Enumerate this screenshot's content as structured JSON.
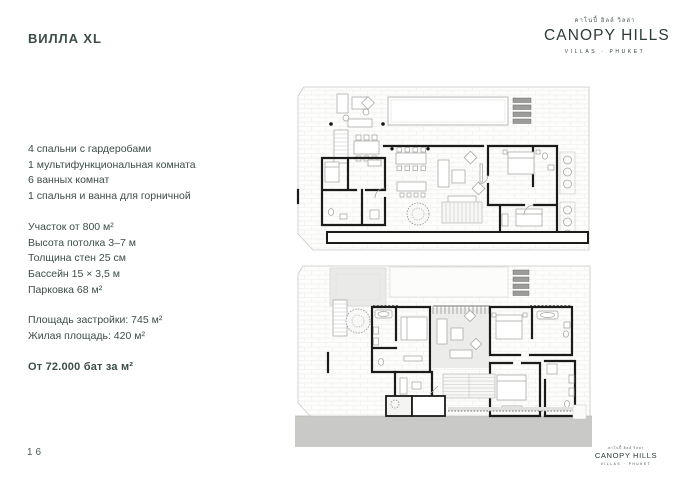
{
  "page": {
    "title": "ВИЛЛА XL",
    "page_number": "16"
  },
  "logo": {
    "thai_script": "คาโนปี้ ฮิลล์ วิลล่า",
    "brand": "CANOPY HILLS",
    "tagline": "VILLAS · PHUKET"
  },
  "specs": {
    "rooms": [
      "4 спальни с гардеробами",
      "1 мультифункциональная комната",
      "6 ванных комнат",
      "1 спальня и ванна для горничной"
    ],
    "details": [
      "Участок от 800 м²",
      "Высота потолка 3–7 м",
      "Толщина стен 25 см",
      "Бассейн 15 × 3,5 м",
      "Парковка 68 м²"
    ],
    "areas": [
      "Площадь застройки: 745 м²",
      "Жилая площадь: 420 м²"
    ],
    "price": "От 72.000 бат за м²"
  },
  "colors": {
    "text": "#3d4d47",
    "brand": "#2e3d38",
    "plan_walls": "#1b1b1b",
    "plan_light_line": "#c8c8c8",
    "terrace_gray": "#eaeae8",
    "driveway_gray": "#c9c9c7",
    "louver_gray": "#9c9c9a"
  }
}
